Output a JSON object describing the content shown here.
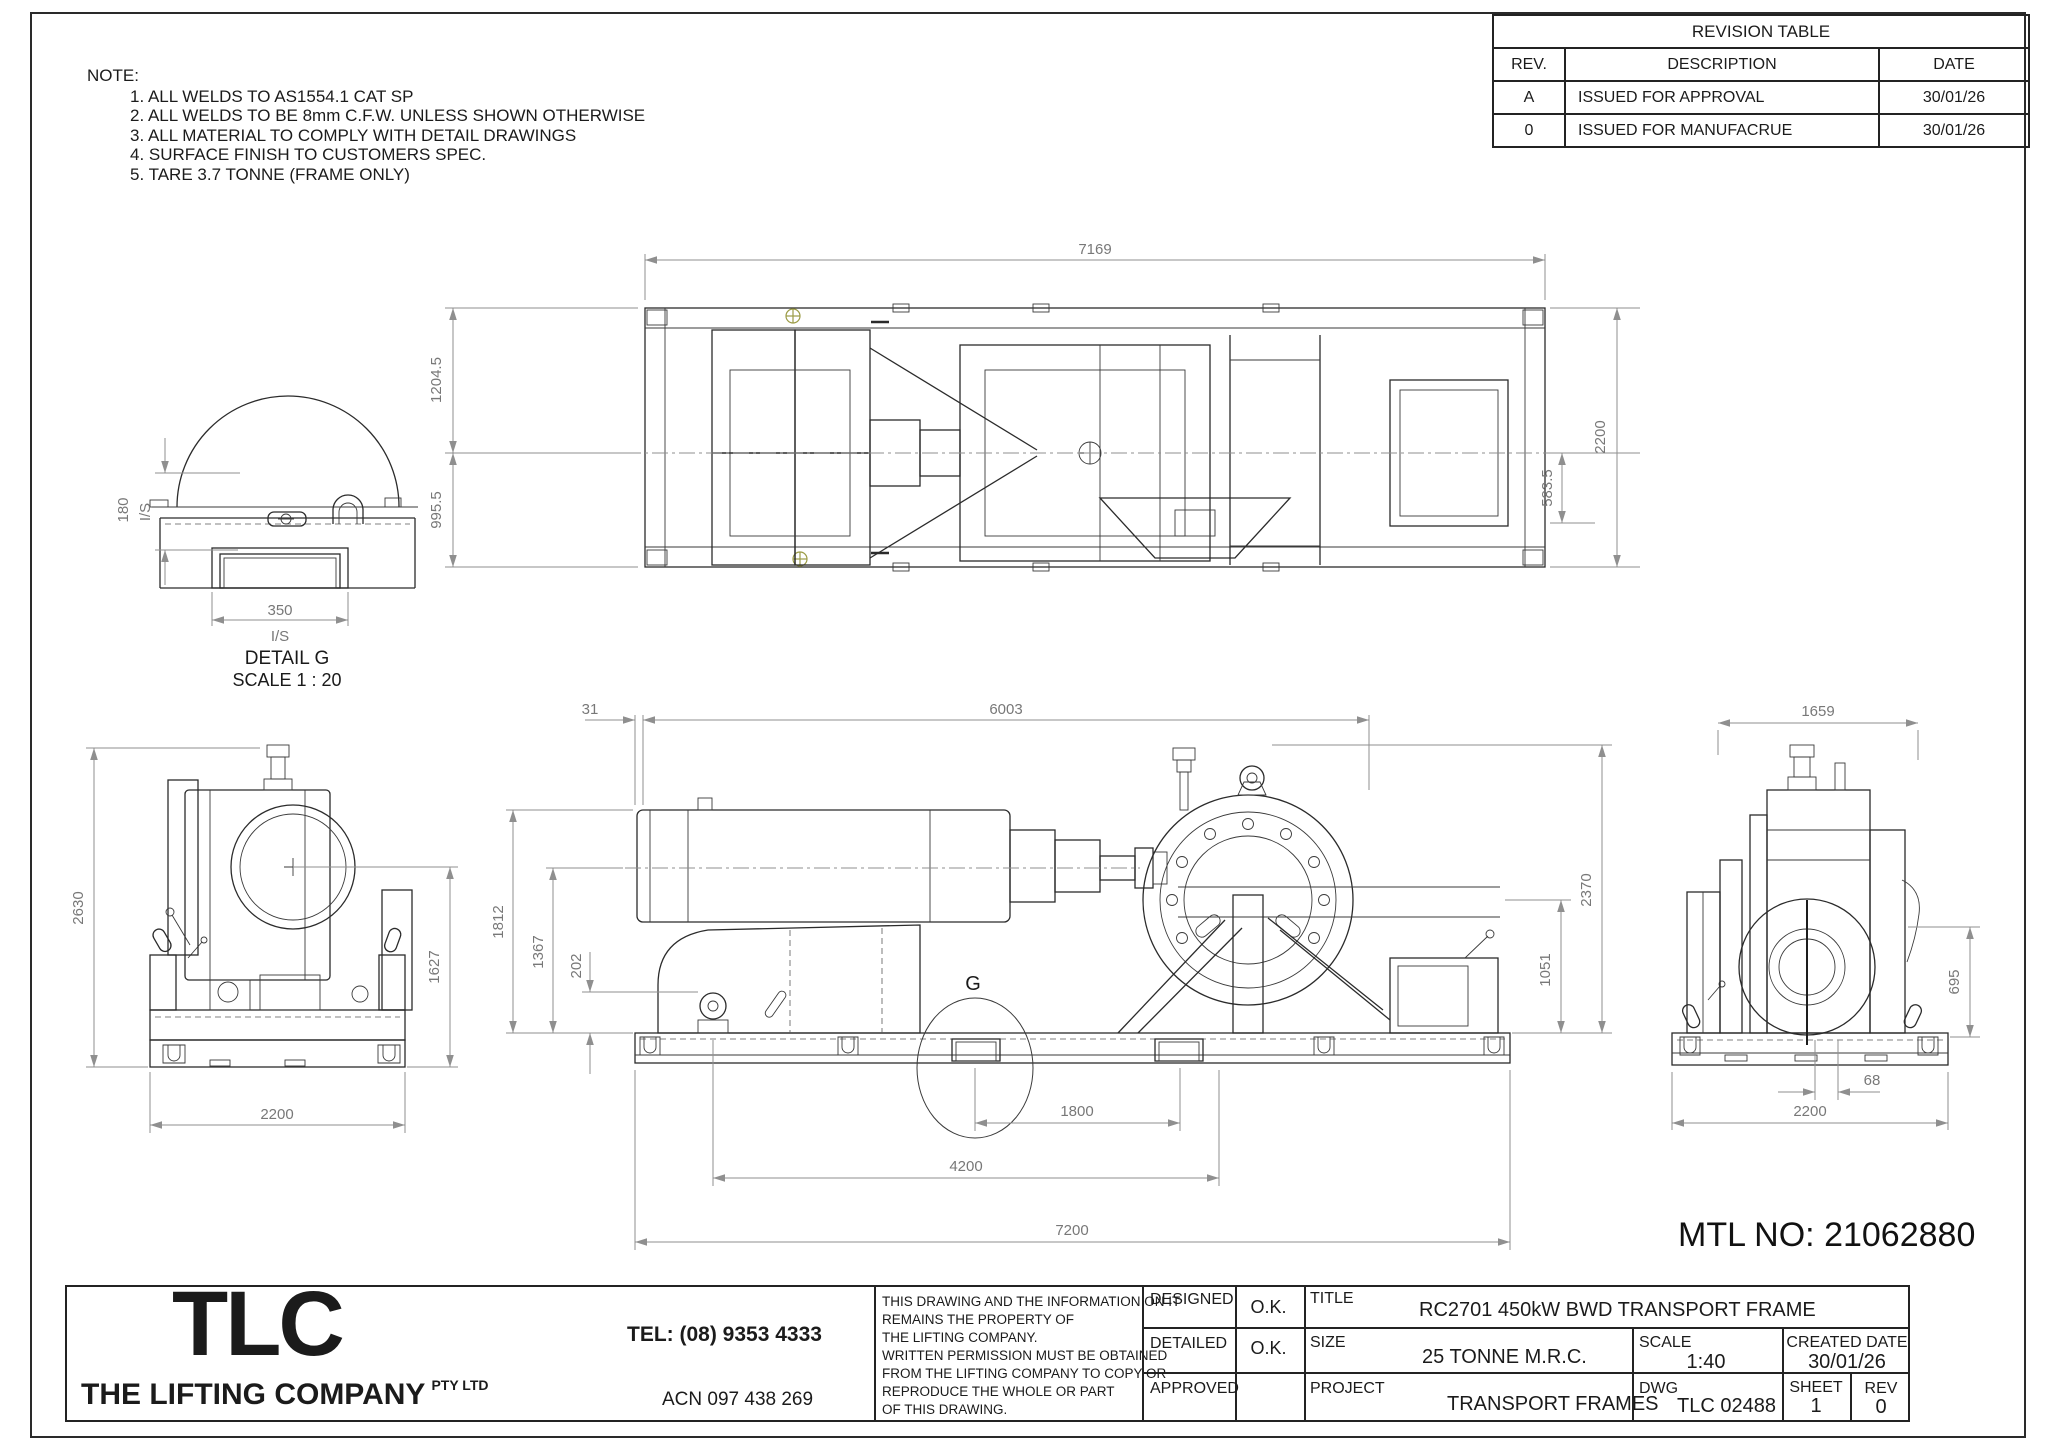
{
  "notes": {
    "heading": "NOTE:",
    "items": [
      "1. ALL WELDS TO AS1554.1 CAT SP",
      "2. ALL WELDS TO BE 8mm C.F.W. UNLESS SHOWN OTHERWISE",
      "3. ALL MATERIAL TO COMPLY WITH DETAIL DRAWINGS",
      "4. SURFACE FINISH TO CUSTOMERS SPEC.",
      "5. TARE 3.7 TONNE (FRAME ONLY)"
    ]
  },
  "revision_table": {
    "title": "REVISION TABLE",
    "headers": [
      "REV.",
      "DESCRIPTION",
      "DATE"
    ],
    "rows": [
      {
        "rev": "A",
        "description": "ISSUED FOR APPROVAL",
        "date": "30/01/26"
      },
      {
        "rev": "0",
        "description": "ISSUED FOR MANUFACRUE",
        "date": "30/01/26"
      }
    ]
  },
  "views": {
    "plan": {
      "dims": {
        "length": "7169",
        "half_width_top": "1204.5",
        "half_width_bottom": "995.5",
        "overall_width": "2200",
        "inner_offset": "583.5"
      }
    },
    "detail_g": {
      "title": "DETAIL G",
      "scale_label": "SCALE 1 : 20",
      "dims": {
        "height": "180",
        "height_note": "I/S",
        "width": "350",
        "width_note": "I/S"
      }
    },
    "left_end": {
      "dims": {
        "overall_height": "2630",
        "frame_height": "1627",
        "base_width": "2200"
      }
    },
    "elevation": {
      "detail_marker": "G",
      "dims": {
        "end_offset": "31",
        "body_length": "6003",
        "cylinder_height": "1812",
        "centre_height": "1367",
        "lug_height": "202",
        "overall_height": "2370",
        "drum_centre_height": "1051",
        "pocket_spacing": "1800",
        "lug_spacing": "4200",
        "overall_length": "7200"
      }
    },
    "right_end": {
      "dims": {
        "body_width": "1659",
        "drum_centre_height": "695",
        "centre_offset": "68",
        "base_width": "2200"
      }
    }
  },
  "mtl_no": "MTL NO: 21062880",
  "title_block": {
    "company": {
      "logo": "TLC",
      "name": "THE LIFTING COMPANY",
      "suffix": "PTY LTD",
      "tel": "TEL: (08) 9353 4333",
      "acn": "ACN 097 438 269"
    },
    "disclaimer": [
      "THIS DRAWING AND THE INFORMATION ON IT",
      "REMAINS THE PROPERTY OF",
      "THE LIFTING COMPANY.",
      "WRITTEN PERMISSION MUST BE OBTAINED",
      "FROM THE LIFTING COMPANY TO COPY OR",
      "REPRODUCE THE WHOLE OR PART",
      "OF THIS DRAWING."
    ],
    "designed_label": "DESIGNED",
    "designed_value": "O.K.",
    "detailed_label": "DETAILED",
    "detailed_value": "O.K.",
    "approved_label": "APPROVED",
    "approved_value": "",
    "title_label": "TITLE",
    "title_value": "RC2701 450kW BWD TRANSPORT FRAME",
    "size_label": "SIZE",
    "size_value": "25 TONNE M.R.C.",
    "scale_label": "SCALE",
    "scale_value": "1:40",
    "created_label": "CREATED DATE",
    "created_value": "30/01/26",
    "project_label": "PROJECT",
    "project_value": "TRANSPORT FRAMES",
    "dwg_label": "DWG",
    "dwg_value": "TLC 02488",
    "sheet_label": "SHEET",
    "sheet_value": "1",
    "rev_label": "REV",
    "rev_value": "0"
  }
}
